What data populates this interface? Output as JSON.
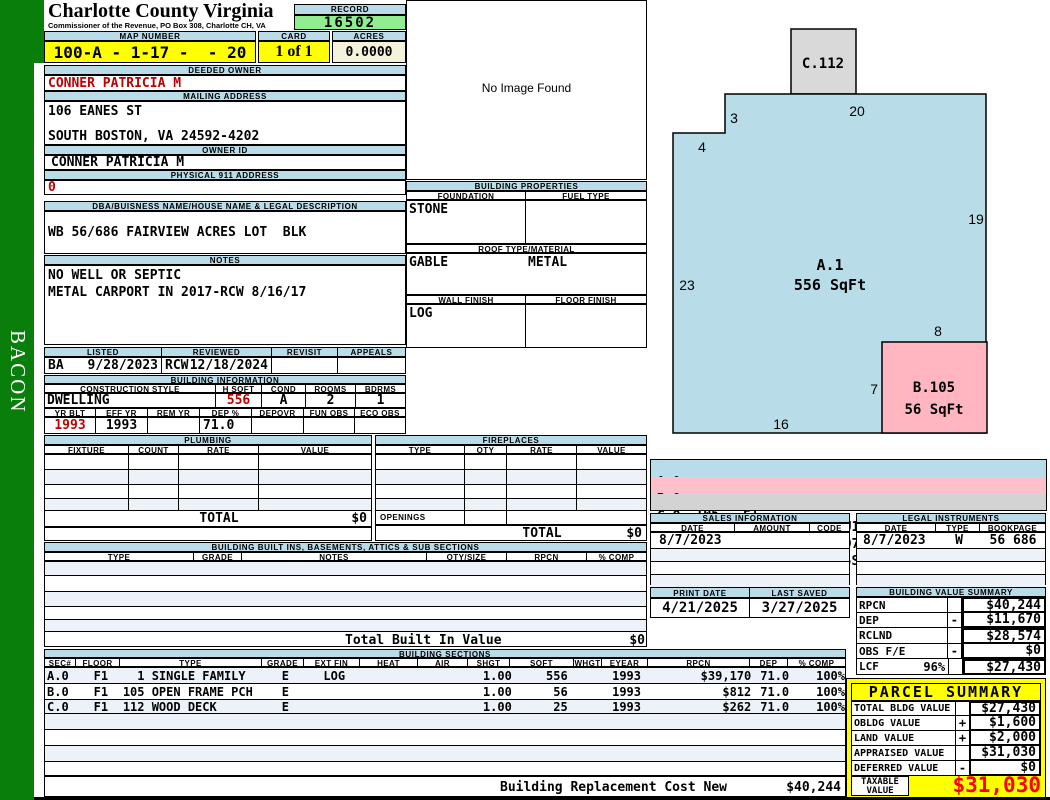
{
  "sidebar": {
    "vertical_text": "BACON"
  },
  "header": {
    "county": "Charlotte County Virginia",
    "commissioner": "Commissioner of the Revenue, PO Box 308, Charlotte CH, VA",
    "record_label": "RECORD",
    "record_value": "16502",
    "map_number_label": "MAP NUMBER",
    "map_number": "100-A - 1-17 -  - 20",
    "card_label": "CARD",
    "card": "1 of 1",
    "acres_label": "ACRES",
    "acres": "0.0000"
  },
  "owner": {
    "deeded_owner_label": "DEEDED OWNER",
    "deeded_owner": "CONNER PATRICIA M",
    "mailing_address_label": "MAILING ADDRESS",
    "mailing_line1": "106 EANES ST",
    "mailing_line2": "SOUTH BOSTON, VA 24592-4202",
    "owner_id_label": "OWNER ID",
    "owner_id": "CONNER PATRICIA M",
    "physical_label": "PHYSICAL 911 ADDRESS",
    "physical": "0",
    "dba_label": "DBA/BUISNESS NAME/HOUSE NAME & LEGAL DESCRIPTION",
    "dba": "WB 56/686 FAIRVIEW ACRES LOT  BLK",
    "notes_label": "NOTES",
    "notes_line1": "NO WELL OR SEPTIC",
    "notes_line2": "METAL CARPORT IN 2017-RCW 8/16/17"
  },
  "visit": {
    "listed_label": "LISTED",
    "reviewed_label": "REVIEWED",
    "revisit_label": "REVISIT",
    "appeals_label": "APPEALS",
    "listed_by": "BA",
    "listed_date": "9/28/2023",
    "reviewed_by": "RCW",
    "reviewed_date": "12/18/2024",
    "revisit": "",
    "appeals": ""
  },
  "building_info": {
    "title": "BUILDING INFORMATION",
    "style_label": "CONSTRUCTION STYLE",
    "hsqft_label": "H SQFT",
    "cond_label": "COND",
    "rooms_label": "ROOMS",
    "bdrms_label": "BDRMS",
    "style": "DWELLING",
    "hsqft": "556",
    "cond": "A",
    "rooms": "2",
    "bdrms": "1",
    "yrblt_label": "YR BLT",
    "effyr_label": "EFF YR",
    "remyr_label": "REM YR",
    "dep_label": "DEP %",
    "depovr_label": "DEPOVR",
    "funobs_label": "FUN OBS",
    "ecoobs_label": "ECO OBS",
    "yr_blt": "1993",
    "eff_yr": "1993",
    "rem_yr": "",
    "dep_pct": "71.0",
    "depovr": "",
    "fun_obs": "",
    "eco_obs": ""
  },
  "image_box": {
    "no_image_text": "No Image Found"
  },
  "building_properties": {
    "title": "BUILDING PROPERTIES",
    "foundation_label": "FOUNDATION",
    "fuel_label": "FUEL TYPE",
    "foundation": "STONE",
    "fuel": "",
    "roof_label": "ROOF TYPE/MATERIAL",
    "roof_type": "GABLE",
    "roof_material": "METAL",
    "wall_label": "WALL FINISH",
    "floor_label": "FLOOR FINISH",
    "wall": "LOG",
    "floor": ""
  },
  "plumbing": {
    "title": "PLUMBING",
    "headers": [
      "FIXTURE",
      "COUNT",
      "RATE",
      "VALUE"
    ],
    "total_label": "TOTAL",
    "total": "$0"
  },
  "fireplaces": {
    "title": "FIREPLACES",
    "headers": [
      "TYPE",
      "QTY",
      "RATE",
      "VALUE"
    ],
    "openings_label": "OPENINGS",
    "total_label": "TOTAL",
    "total": "$0"
  },
  "built_ins": {
    "title": "BUILDING BUILT INS, BASEMENTS, ATTICS & SUB SECTIONS",
    "headers": [
      "TYPE",
      "GRADE",
      "NOTES",
      "QTY/SIZE",
      "RPCN",
      "% COMP"
    ],
    "total_label": "Total Built In Value",
    "total": "$0"
  },
  "building_sections": {
    "title": "BUILDING SECTIONS",
    "headers": [
      "SEC#",
      "FLOOR",
      "TYPE",
      "GRADE",
      "EXT FIN",
      "HEAT",
      "AIR",
      "SHGT",
      "SQFT",
      "WHGT",
      "EYEAR",
      "RPCN",
      "DEP",
      "% COMP"
    ],
    "rows": [
      {
        "sec": "A.0",
        "floor": "F1",
        "type": "  1 SINGLE FAMILY",
        "grade": "E",
        "extfin": "LOG",
        "heat": "",
        "air": "",
        "shgt": "1.00",
        "sqft": "556",
        "whgt": "",
        "eyear": "1993",
        "rpcn": "$39,170",
        "dep": "71.0",
        "comp": "100%"
      },
      {
        "sec": "B.0",
        "floor": "F1",
        "type": "105 OPEN FRAME PCH",
        "grade": "E",
        "extfin": "",
        "heat": "",
        "air": "",
        "shgt": "1.00",
        "sqft": "56",
        "whgt": "",
        "eyear": "1993",
        "rpcn": "$812",
        "dep": "71.0",
        "comp": "100%"
      },
      {
        "sec": "C.0",
        "floor": "F1",
        "type": "112 WOOD DECK",
        "grade": "E",
        "extfin": "",
        "heat": "",
        "air": "",
        "shgt": "1.00",
        "sqft": "25",
        "whgt": "",
        "eyear": "1993",
        "rpcn": "$262",
        "dep": "71.0",
        "comp": "100%"
      }
    ],
    "footer_label": "Building Replacement Cost New",
    "footer_value": "$40,244"
  },
  "sketch": {
    "main_id": "A.1",
    "main_sqft": "556 SqFt",
    "porch_id": "B.105",
    "porch_sqft": "56 SqFt",
    "deck_id": "C.112",
    "dim_top": "20",
    "dim_notch": "3",
    "dim_step": "4",
    "dim_right": "19",
    "dim_left": "23",
    "dim_bottom": "16",
    "dim_porch_top": "8",
    "dim_porch_left": "7",
    "colors": {
      "main": "#B8DCE8",
      "porch": "#FFB6C1",
      "deck": "#D9D9D9"
    }
  },
  "sketch_codes": {
    "rows": [
      {
        "sec": "A.0",
        "code": "1",
        "floor": "F1",
        "vector": "SR16U7R8U19L20D3L4D23."
      },
      {
        "sec": "B.0",
        "code": "105",
        "floor": "F1",
        "vector": "R16SU7R8D7L8."
      },
      {
        "sec": "C.0",
        "code": "112",
        "floor": "F1",
        "vector": "U23R4U3R5SU5R5D5L5."
      }
    ]
  },
  "sales": {
    "title": "SALES INFORMATION",
    "headers": [
      "DATE",
      "AMOUNT",
      "CODE"
    ],
    "rows": [
      {
        "date": "8/7/2023",
        "amount": "",
        "code": ""
      }
    ]
  },
  "legal": {
    "title": "LEGAL INSTRUMENTS",
    "headers": [
      "DATE",
      "TYPE",
      "BOOKPAGE"
    ],
    "rows": [
      {
        "date": "8/7/2023",
        "type": "W",
        "bookpage": "56 686"
      }
    ]
  },
  "dates": {
    "print_label": "PRINT DATE",
    "print": "4/21/2025",
    "saved_label": "LAST SAVED",
    "saved": "3/27/2025"
  },
  "value_summary": {
    "title": "BUILDING VALUE SUMMARY",
    "rows": [
      {
        "label": "RPCN",
        "pct": "",
        "op": "",
        "value": "$40,244"
      },
      {
        "label": "DEP",
        "pct": "",
        "op": "-",
        "value": "$11,670"
      },
      {
        "label": "RCLND",
        "pct": "",
        "op": "",
        "value": "$28,574"
      },
      {
        "label": "OBS F/E",
        "pct": "",
        "op": "-",
        "value": "$0"
      },
      {
        "label": "LCF",
        "pct": "96%",
        "op": "",
        "value": "$27,430"
      }
    ]
  },
  "parcel_summary": {
    "title": "PARCEL SUMMARY",
    "rows": [
      {
        "label": "TOTAL BLDG VALUE",
        "op": "",
        "value": "$27,430"
      },
      {
        "label": "OBLDG VALUE",
        "op": "+",
        "value": "$1,600"
      },
      {
        "label": "LAND VALUE",
        "op": "+",
        "value": "$2,000"
      },
      {
        "label": "APPRAISED VALUE",
        "op": "",
        "value": "$31,030"
      },
      {
        "label": "DEFERRED VALUE",
        "op": "-",
        "value": "$0"
      }
    ],
    "taxable_label_1": "TAXABLE",
    "taxable_label_2": "VALUE",
    "taxable_value": "$31,030"
  }
}
